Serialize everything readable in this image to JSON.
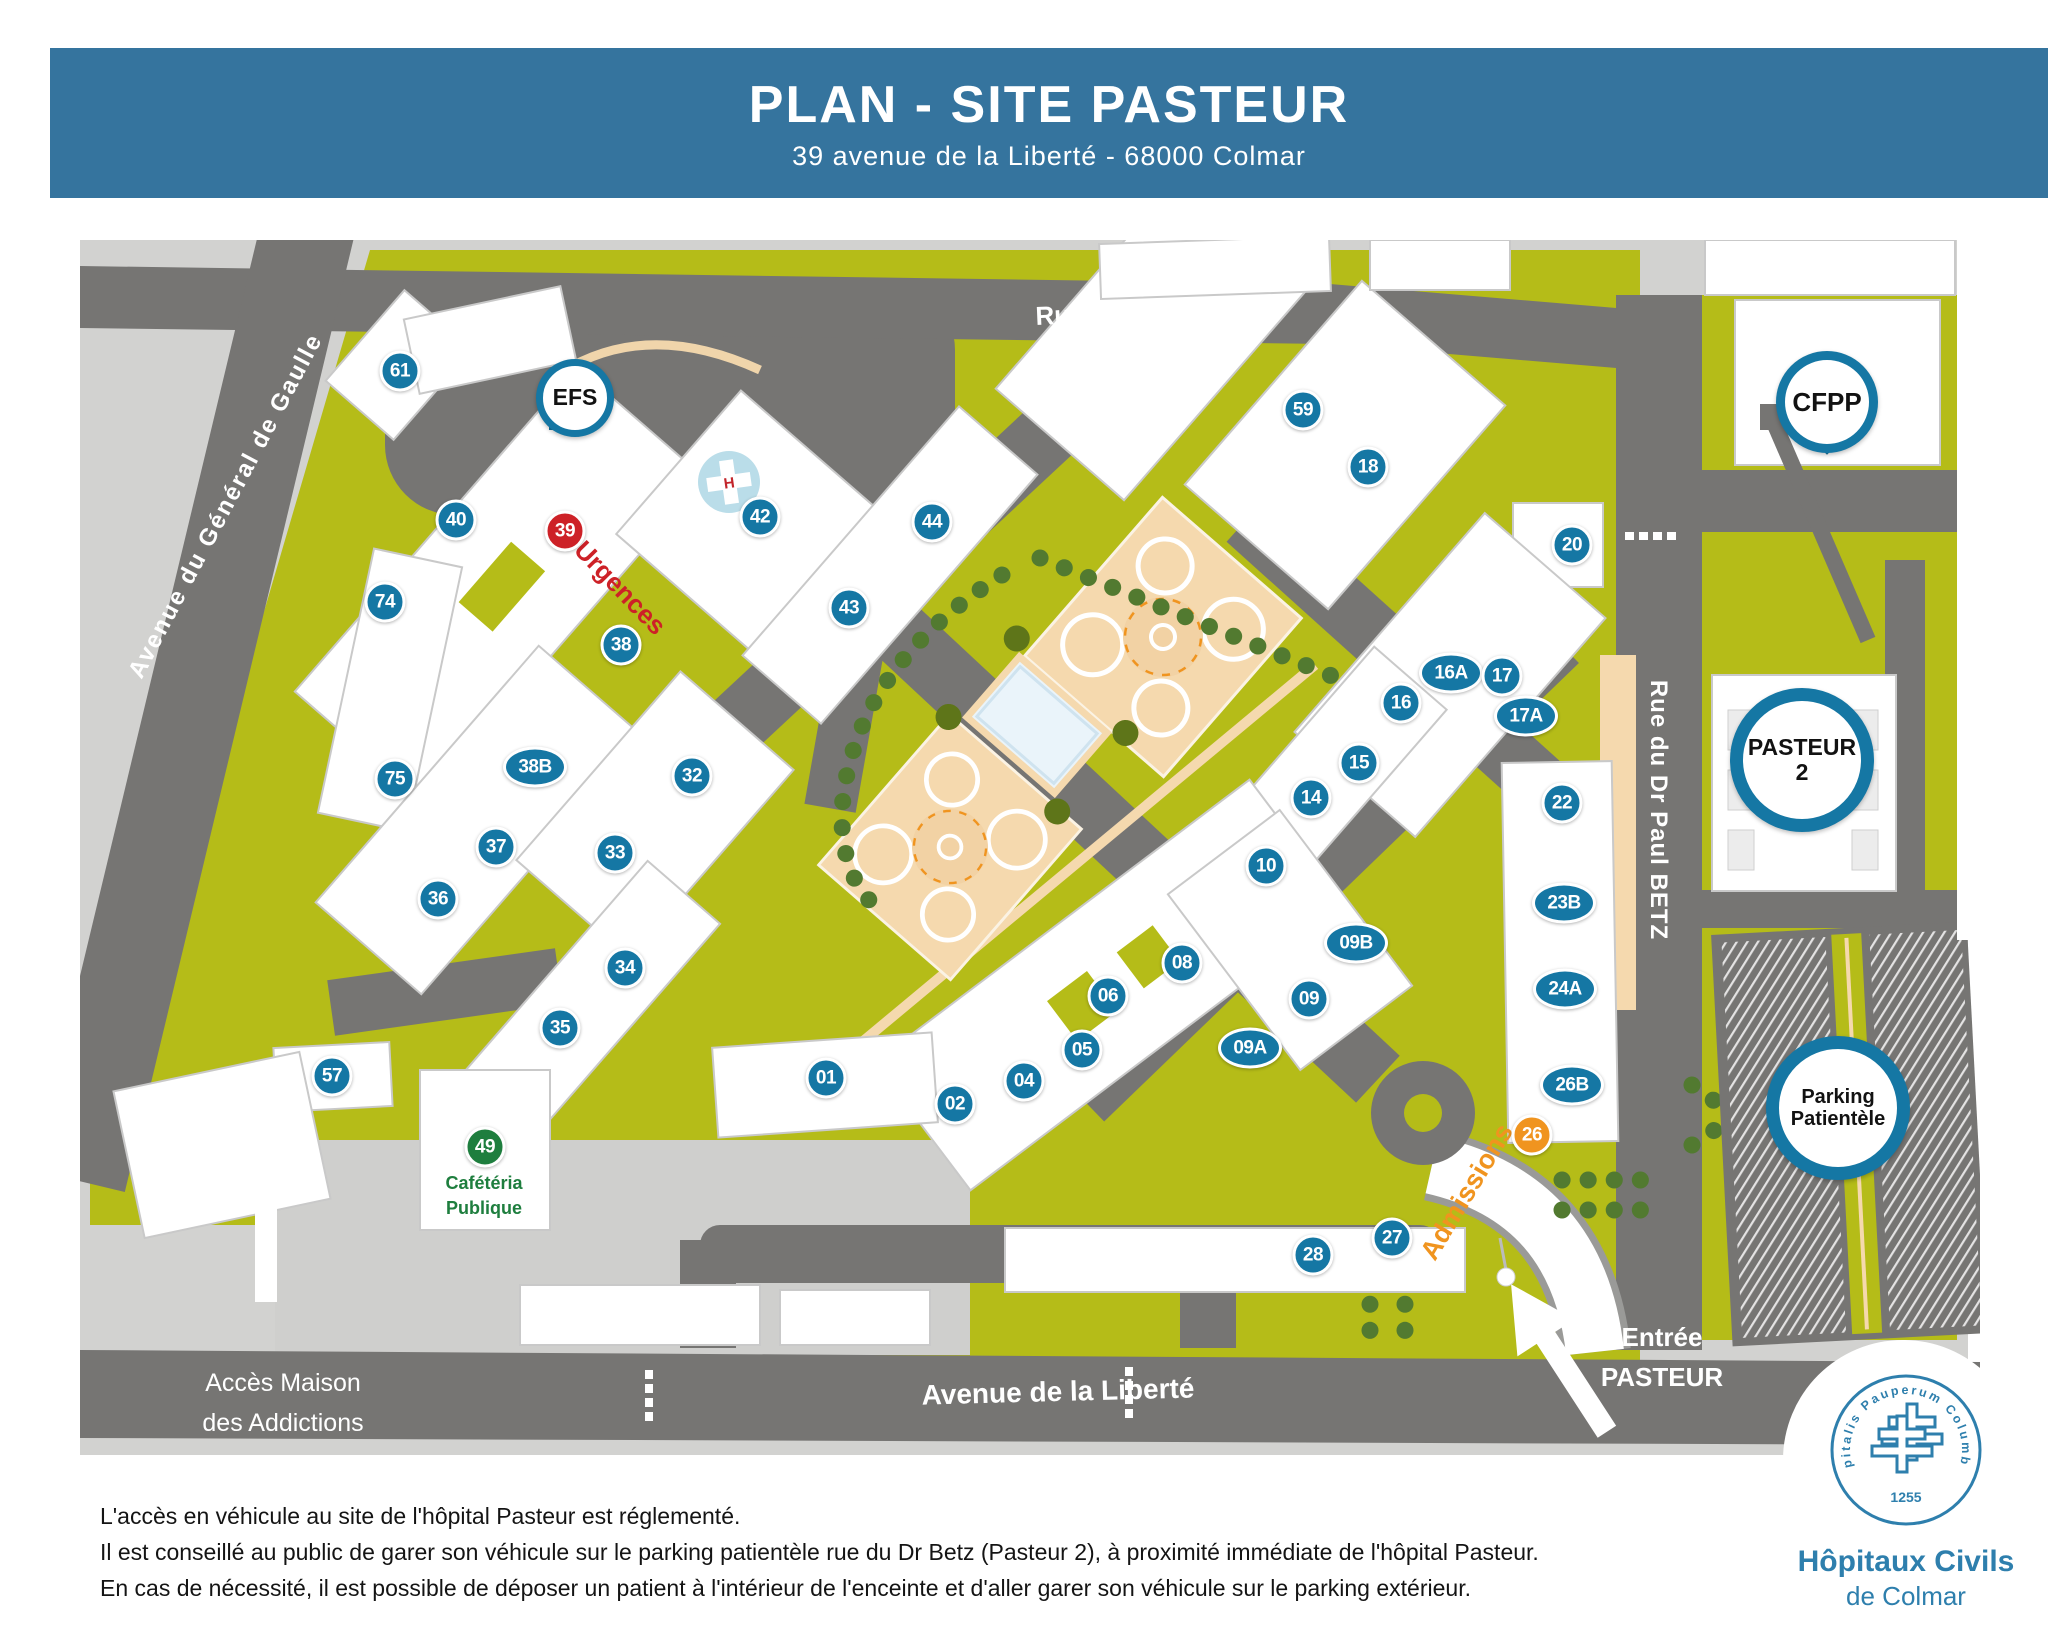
{
  "header": {
    "title": "PLAN - SITE PASTEUR",
    "subtitle": "39 avenue de la Liberté - 68000 Colmar"
  },
  "map": {
    "streets": {
      "hohnack": "Rue du Hohnack",
      "gaulle": "Avenue du Général de Gaulle",
      "betz": "Rue du Dr Paul BETZ",
      "liberte": "Avenue de la Liberté"
    },
    "labels": {
      "urgences": "Urgences",
      "admissions": "Admissions",
      "cafeteria_line1": "Cafétéria",
      "cafeteria_line2": "Publique",
      "entree_line1": "Entrée",
      "entree_line2": "PASTEUR",
      "acces_line1": "Accès Maison",
      "acces_line2": "des Addictions"
    },
    "pins": [
      {
        "id": "efs",
        "lines": [
          "EFS"
        ],
        "x": 575,
        "y": 398,
        "size": "small",
        "tail": "downleft"
      },
      {
        "id": "cfpp",
        "lines": [
          "CFPP"
        ],
        "x": 1827,
        "y": 402,
        "size": "medium",
        "tail": "down"
      },
      {
        "id": "pasteur2",
        "lines": [
          "PASTEUR",
          "2"
        ],
        "x": 1802,
        "y": 760,
        "size": "large",
        "tail": "down"
      },
      {
        "id": "parking",
        "lines": [
          "Parking",
          "Patientèle"
        ],
        "x": 1838,
        "y": 1108,
        "size": "large",
        "tail": "down"
      }
    ],
    "markers": [
      {
        "label": "61",
        "x": 400,
        "y": 371,
        "type": "blue"
      },
      {
        "label": "40",
        "x": 456,
        "y": 520,
        "type": "blue"
      },
      {
        "label": "39",
        "x": 565,
        "y": 531,
        "type": "red"
      },
      {
        "label": "74",
        "x": 385,
        "y": 602,
        "type": "blue"
      },
      {
        "label": "38",
        "x": 621,
        "y": 645,
        "type": "blue"
      },
      {
        "label": "42",
        "x": 760,
        "y": 517,
        "type": "blue"
      },
      {
        "label": "44",
        "x": 932,
        "y": 522,
        "type": "blue"
      },
      {
        "label": "43",
        "x": 849,
        "y": 608,
        "type": "blue"
      },
      {
        "label": "59",
        "x": 1303,
        "y": 410,
        "type": "blue"
      },
      {
        "label": "18",
        "x": 1368,
        "y": 467,
        "type": "blue"
      },
      {
        "label": "20",
        "x": 1572,
        "y": 545,
        "type": "blue"
      },
      {
        "label": "16A",
        "x": 1451,
        "y": 673,
        "type": "blue",
        "wide": true
      },
      {
        "label": "17",
        "x": 1502,
        "y": 676,
        "type": "blue"
      },
      {
        "label": "16",
        "x": 1401,
        "y": 703,
        "type": "blue"
      },
      {
        "label": "17A",
        "x": 1526,
        "y": 716,
        "type": "blue",
        "wide": true
      },
      {
        "label": "15",
        "x": 1359,
        "y": 763,
        "type": "blue"
      },
      {
        "label": "14",
        "x": 1311,
        "y": 798,
        "type": "blue"
      },
      {
        "label": "22",
        "x": 1562,
        "y": 803,
        "type": "blue"
      },
      {
        "label": "10",
        "x": 1266,
        "y": 866,
        "type": "blue"
      },
      {
        "label": "23B",
        "x": 1564,
        "y": 903,
        "type": "blue",
        "wide": true
      },
      {
        "label": "09B",
        "x": 1356,
        "y": 943,
        "type": "blue",
        "wide": true
      },
      {
        "label": "08",
        "x": 1182,
        "y": 963,
        "type": "blue"
      },
      {
        "label": "24A",
        "x": 1565,
        "y": 989,
        "type": "blue",
        "wide": true
      },
      {
        "label": "06",
        "x": 1108,
        "y": 996,
        "type": "blue"
      },
      {
        "label": "09",
        "x": 1309,
        "y": 999,
        "type": "blue"
      },
      {
        "label": "09A",
        "x": 1250,
        "y": 1048,
        "type": "blue",
        "wide": true
      },
      {
        "label": "05",
        "x": 1082,
        "y": 1050,
        "type": "blue"
      },
      {
        "label": "01",
        "x": 826,
        "y": 1078,
        "type": "blue"
      },
      {
        "label": "04",
        "x": 1024,
        "y": 1081,
        "type": "blue"
      },
      {
        "label": "26B",
        "x": 1572,
        "y": 1085,
        "type": "blue",
        "wide": true
      },
      {
        "label": "02",
        "x": 955,
        "y": 1104,
        "type": "blue"
      },
      {
        "label": "26",
        "x": 1532,
        "y": 1135,
        "type": "orange"
      },
      {
        "label": "57",
        "x": 332,
        "y": 1076,
        "type": "blue"
      },
      {
        "label": "49",
        "x": 485,
        "y": 1147,
        "type": "green"
      },
      {
        "label": "27",
        "x": 1392,
        "y": 1238,
        "type": "blue"
      },
      {
        "label": "28",
        "x": 1313,
        "y": 1255,
        "type": "blue"
      },
      {
        "label": "32",
        "x": 692,
        "y": 776,
        "type": "blue"
      },
      {
        "label": "75",
        "x": 395,
        "y": 779,
        "type": "blue"
      },
      {
        "label": "38B",
        "x": 535,
        "y": 767,
        "type": "blue",
        "wide": true
      },
      {
        "label": "37",
        "x": 496,
        "y": 847,
        "type": "blue"
      },
      {
        "label": "33",
        "x": 615,
        "y": 853,
        "type": "blue"
      },
      {
        "label": "36",
        "x": 438,
        "y": 899,
        "type": "blue"
      },
      {
        "label": "34",
        "x": 625,
        "y": 968,
        "type": "blue"
      },
      {
        "label": "35",
        "x": 560,
        "y": 1028,
        "type": "blue"
      }
    ]
  },
  "footer": {
    "line1": "L'accès en véhicule au site de l'hôpital Pasteur est réglementé.",
    "line2": "Il est conseillé au public de garer son véhicule sur le parking patientèle rue du Dr Betz (Pasteur 2), à proximité immédiate de l'hôpital Pasteur.",
    "line3": "En cas de nécessité, il est possible de déposer un patient à l'intérieur de l'enceinte et d'aller garer son véhicule sur le parking extérieur."
  },
  "logo": {
    "org_line1": "Hôpitaux Civils",
    "org_line2": "de Colmar",
    "seal_text": "Hospitalis Pauperum Columbaria",
    "seal_year": "1255"
  },
  "colors": {
    "banner": "#35749e",
    "campus_green": "#b5bc18",
    "road_gray": "#767573",
    "base_gray": "#d2d2d0",
    "marker_blue": "#1577a4",
    "marker_red": "#cd2127",
    "marker_orange": "#f0941f",
    "marker_green": "#1e7e3e",
    "logo_blue": "#2e7fad"
  }
}
